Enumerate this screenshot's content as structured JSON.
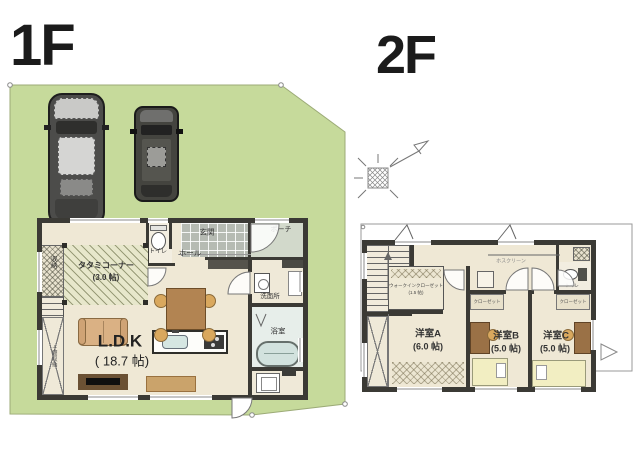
{
  "floor1": {
    "title": "1F",
    "rooms": {
      "tatami": {
        "name": "タタミコーナー",
        "size": "(3.0 帖)"
      },
      "storage": "収納",
      "doma_storage": "土間収納",
      "toilet": "トイレ",
      "hall": "ホール",
      "genkan": "玄関",
      "porch": "ポーチ",
      "washroom": "洗面所",
      "bath": "浴室",
      "ldk": {
        "name": "L.D.K",
        "size": "( 18.7 帖)"
      }
    }
  },
  "floor2": {
    "title": "2F",
    "rooms": {
      "wic": {
        "name": "ウォークインクローゼット",
        "size": "(1.5 帖)"
      },
      "hoscreen": "ホスクリーン",
      "toilet": "トイレ",
      "closetB": "クローゼット",
      "closetC": "クローゼット",
      "roomA": {
        "name": "洋室A",
        "size": "(6.0 帖)"
      },
      "roomB": {
        "name": "洋室B",
        "size": "(5.0 帖)"
      },
      "roomC": {
        "name": "洋室C",
        "size": "(5.0 帖)"
      }
    }
  },
  "colors": {
    "lot_green": "#c6da9b",
    "floor_beige": "#efe8d5",
    "wall_dark": "#3b3a35",
    "tatami": "#e7e7cb",
    "genkan_tile": "#b6bbb3",
    "porch": "#d2d9cb",
    "bathtub": "#d2e2de",
    "wood": "#b28452",
    "bed_yellow": "#f2eec2"
  }
}
